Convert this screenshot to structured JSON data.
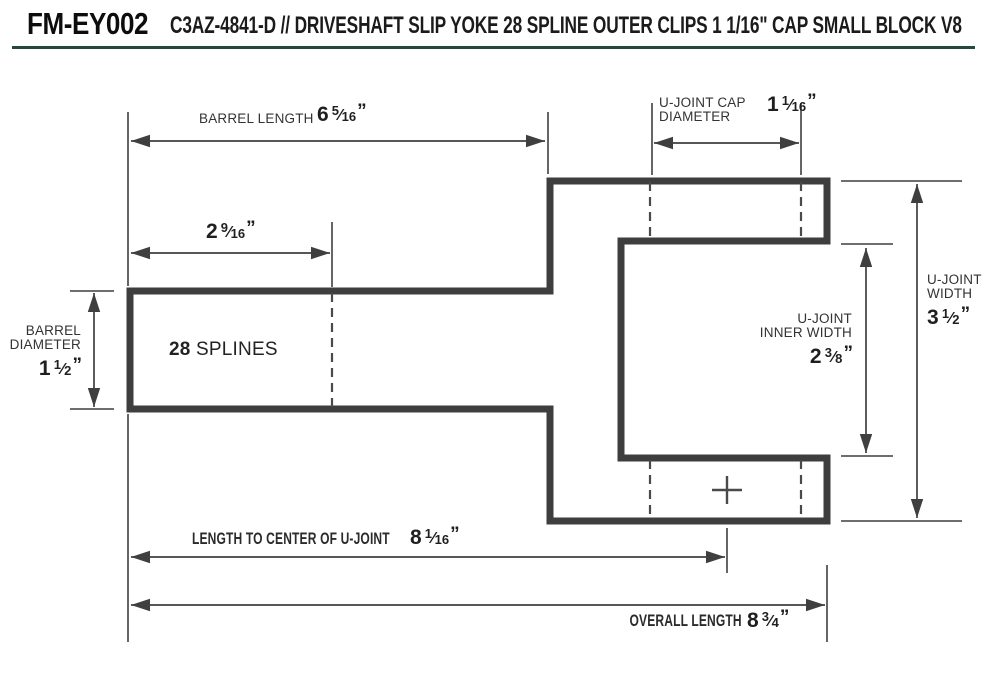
{
  "header": {
    "code": "FM-EY002",
    "title": "C3AZ-4841-D // DRIVESHAFT SLIP YOKE 28 SPLINE OUTER CLIPS 1 1/16\" CAP SMALL BLOCK V8"
  },
  "glyphs": {
    "slash": "⁄",
    "quote": "”"
  },
  "diagram": {
    "splines": {
      "count": "28",
      "label": "SPLINES"
    },
    "dimensions": {
      "barrel_length": {
        "label": "BARREL LENGTH",
        "whole": "6",
        "num": "5",
        "den": "16"
      },
      "cap_diameter": {
        "label_line1": "U-JOINT CAP",
        "label_line2": "DIAMETER",
        "whole": "1",
        "num": "1",
        "den": "16"
      },
      "spline_length": {
        "whole": "2",
        "num": "9",
        "den": "16"
      },
      "barrel_diameter": {
        "label_line1": "BARREL",
        "label_line2": "DIAMETER",
        "whole": "1",
        "num": "1",
        "den": "2"
      },
      "inner_width": {
        "label_line1": "U-JOINT",
        "label_line2": "INNER WIDTH",
        "whole": "2",
        "num": "3",
        "den": "8"
      },
      "ujoint_width": {
        "label_line1": "U-JOINT",
        "label_line2": "WIDTH",
        "whole": "3",
        "num": "1",
        "den": "2"
      },
      "length_to_center": {
        "label": "LENGTH TO CENTER OF U-JOINT",
        "whole": "8",
        "num": "1",
        "den": "16"
      },
      "overall_length": {
        "label": "OVERALL LENGTH",
        "whole": "8",
        "num": "3",
        "den": "4"
      }
    }
  }
}
